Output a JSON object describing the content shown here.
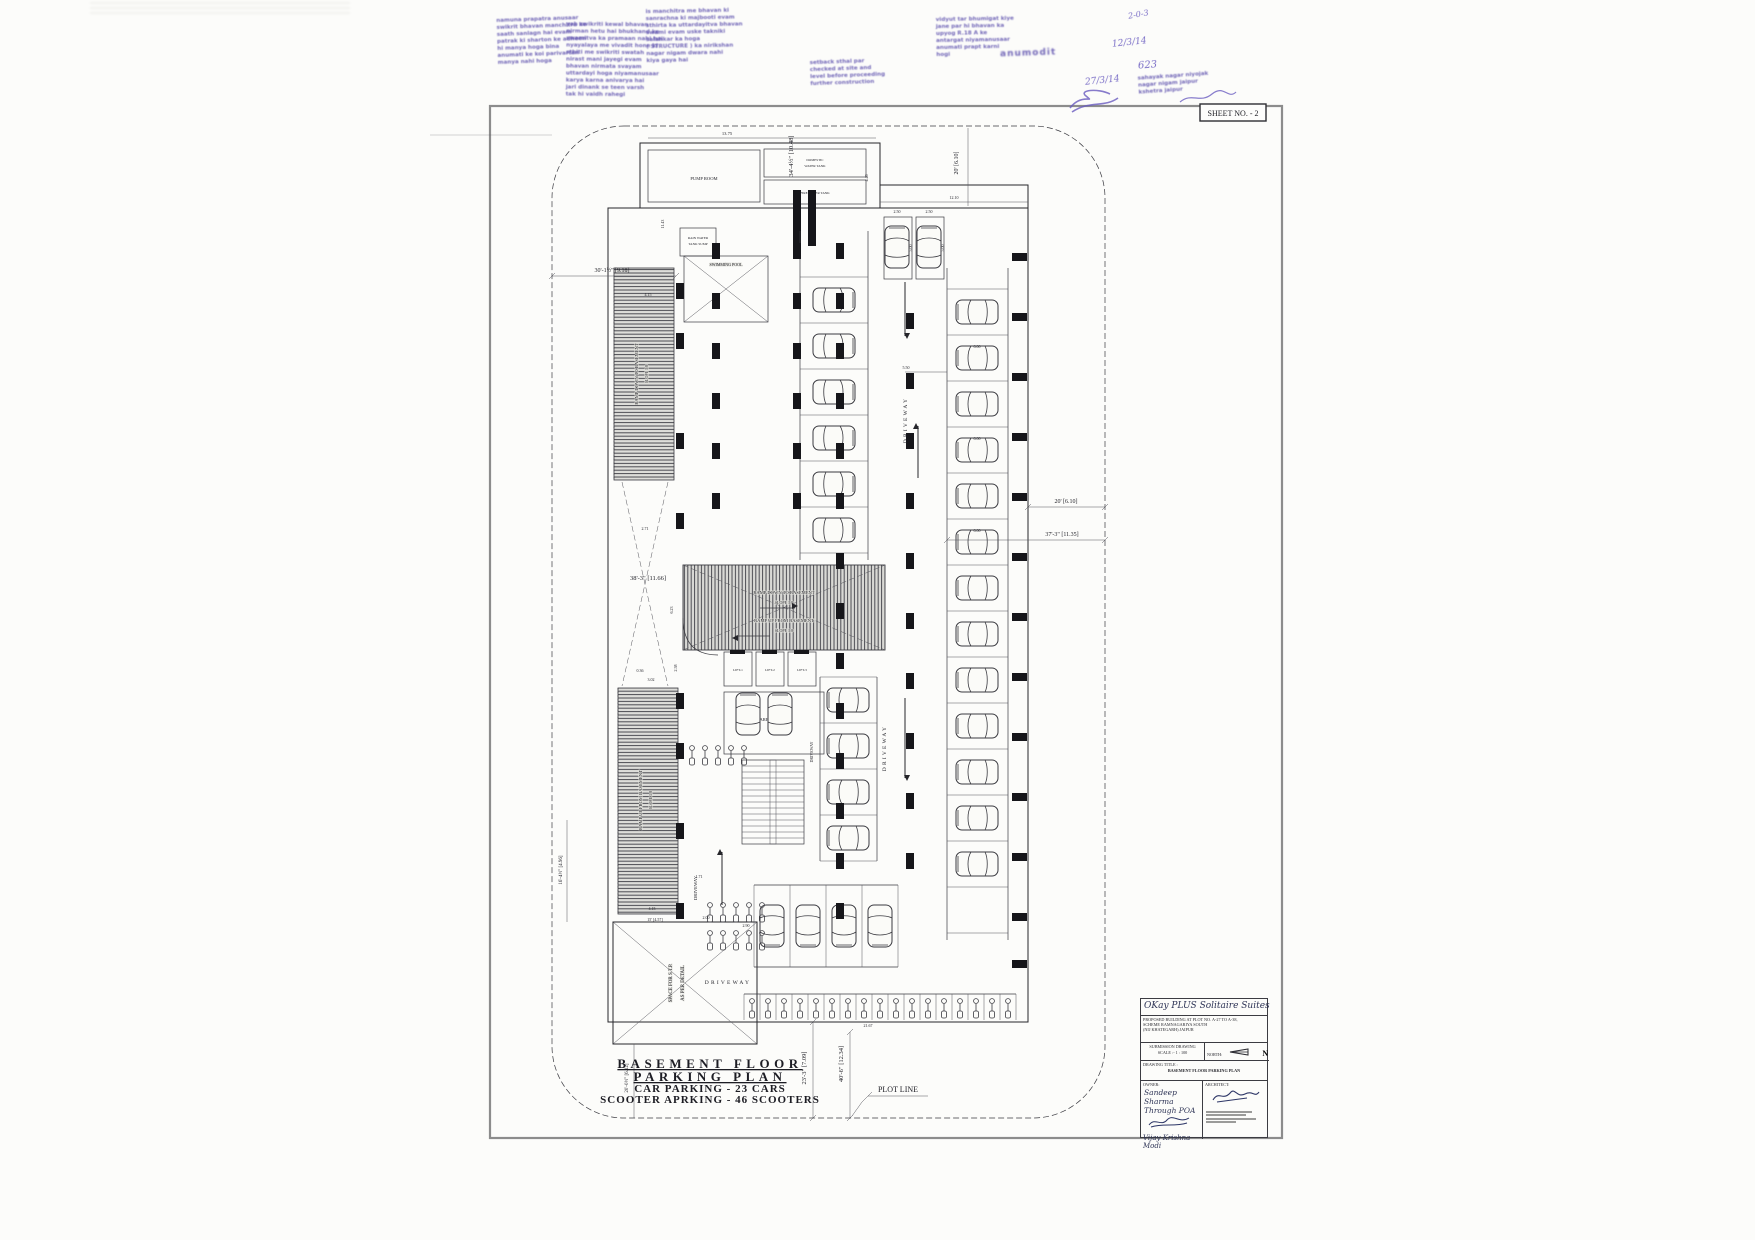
{
  "sheet": {
    "number": "SHEET NO. - 2"
  },
  "plan": {
    "labels": {
      "pump_room": "PUMP ROOM",
      "domestic_tank_l1": "DOMESTIC",
      "domestic_tank_l2": "WATER TANK",
      "fire_tank": "FIRE WATER TANK",
      "rain_sump_l1": "RAIN WATER",
      "rain_sump_l2": "TANK SUMP",
      "swimming_pool": "SWIMMING POOL",
      "ramp_down": "RAMP DOWN TO BASEMENT",
      "ramp_up": "RAMP UP FROM BASEMENT",
      "slope": "SLOPE 1:8",
      "garbage_tank": "GARBAGE TANK",
      "lift1": "LIFT-1",
      "lift2": "LIFT-2",
      "lift3": "LIFT-3",
      "stp_l1": "SPACE FOR S.T.P.",
      "stp_l2": "AS PER DETAIL",
      "driveway": "DRIVEWAY",
      "plot_line": "PLOT LINE"
    },
    "dims": {
      "d1": "34'-4½\" [10.48]",
      "d2": "20' [6.10]",
      "d3": "30'-1½\" [9.18]",
      "d4": "38'-3\" [11.66]",
      "d6": "37'-3\" [11.35]",
      "d7": "23'-3\" [7.09]",
      "d8": "40'-6\" [12.34]",
      "d9": "20'-0½\" [6.12]",
      "d10": "16'-4½\" [4.96]",
      "d11": "15' [4.57]",
      "d12": "13.75",
      "d13": "12.10",
      "d14": "11.43",
      "d15": "4.15",
      "d16": "6.23",
      "d17": "2.58",
      "d18": "0.36",
      "d19": "3.02",
      "d20": "2.71",
      "d21": "5.50",
      "d22": "6.00",
      "d23": "2.50",
      "d24": "5.00",
      "d25": "21.67",
      "d26": "2.90",
      "d27": "1.71",
      "d28": "2.00",
      "d29": "4.46"
    },
    "title_lines": [
      "BASEMENT FLOOR",
      "PARKING PLAN",
      "CAR PARKING - 23 CARS",
      "SCOOTER APRKING - 46 SCOOTERS"
    ]
  },
  "title_block": {
    "project_name": "OKay PLUS Solitaire Suites",
    "address_line1": "PROPOSED BUILDING AT PLOT NO. A-27 TO A-38,",
    "address_line2": "SCHEME RAMNAGARIYA SOUTH",
    "address_line3": "(NIJ KHATEGARH) JAIPUR",
    "submission_label": "SUBMISSION DRAWING",
    "scale_label": "SCALE :- 1 : 100",
    "north_label": "NORTH:",
    "north_letter": "N",
    "drawing_title_label": "DRAWING TITLE :",
    "drawing_title": "BASEMENT FLOOR PARKING PLAN",
    "owner_label": "OWNER:",
    "owner_name": "Sandeep Sharma",
    "owner_through": "Through POA",
    "owner_sign_name": "Vijay Krishna Modi",
    "architect_label": "ARCHITECT:"
  },
  "stamps": {
    "blocks": [
      {
        "lines": [
          "namuna prapatra anusaar",
          "swikrit bhavan manchitra ke",
          "saath sanlagn hai evam",
          "patrak ki sharton ke adheen",
          "hi manya hoga bina",
          "anumati ke koi parivartan",
          "manya nahi hoga"
        ]
      },
      {
        "lines": [
          "yah swikriti kewal bhavan",
          "nirman hetu hai bhukhand ke",
          "swamitva ka pramaan nahi hai",
          "nyayalaya me vivadit hone ki",
          "sthiti me swikriti swatah",
          "nirast mani jayegi evam",
          "bhavan nirmata svayam",
          "uttardayi hoga niyamanusaar",
          "karya karna anivarya hai",
          "jari dinank se teen varsh",
          "tak hi vaidh rahegi"
        ]
      },
      {
        "lines": [
          "is manchitra me bhavan ki",
          "sanrachna ki majbooti evam",
          "sthirta ka uttardayitva bhavan",
          "swami evam uske takniki",
          "salahkar ka hoga",
          "( STRUCTURE ) ka nirikshan",
          "nagar nigam dwara nahi",
          "kiya gaya hai"
        ]
      },
      {
        "lines": [
          "setback sthal par",
          "checked at site and",
          "level before proceeding",
          "further construction"
        ]
      },
      {
        "lines": [
          "vidyut tar bhumigat kiye",
          "jane par hi bhavan ka",
          "upyog R.18 A ke",
          "antargat niyamanusaar",
          "anumati prapt karni",
          "hogi"
        ]
      },
      {
        "lines": [
          "sahayak nagar niyojak",
          "nagar nigam jaipur",
          "kshetra jaipur"
        ]
      },
      {
        "lines": [
          "anumodit"
        ]
      }
    ],
    "handwritten": [
      "2-0-3",
      "12/3/14",
      "623",
      "27/3/14"
    ]
  }
}
